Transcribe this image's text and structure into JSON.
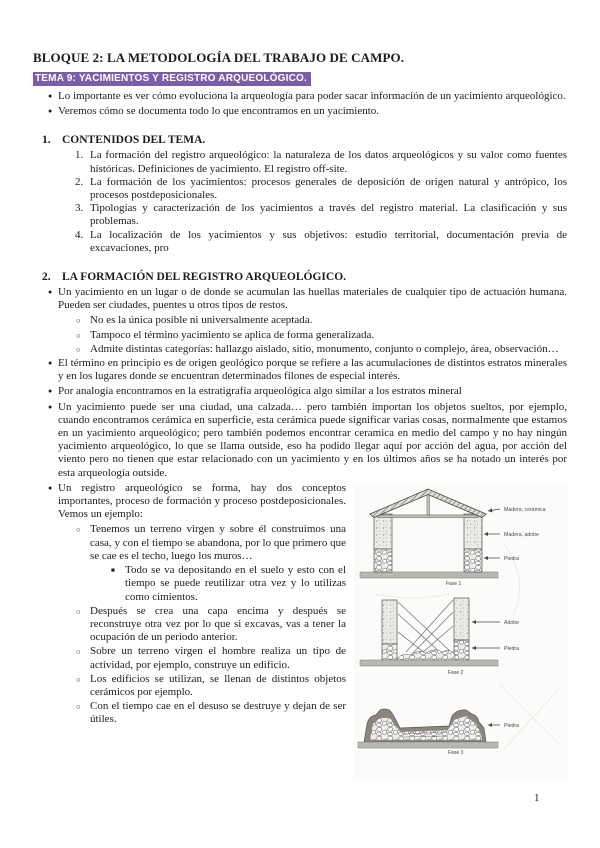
{
  "doc": {
    "title": "BLOQUE 2: LA METODOLOGÍA DEL TRABAJO DE CAMPO.",
    "subtitle": "TEMA 9: YACIMIENTOS Y REGISTRO ARQUEOLÓGICO.",
    "page_number": "1"
  },
  "colors": {
    "highlight_bg": "#7b5ea7",
    "highlight_text": "#ffffff"
  },
  "markers": {
    "level1": "●",
    "level2": "○",
    "level3": "■"
  },
  "intro": {
    "bullets": [
      "Lo importante es ver cómo evoluciona la arqueología para poder sacar información de un yacimiento arqueológico.",
      "Veremos cómo se documenta todo lo que encontramos en un yacimiento."
    ]
  },
  "section1": {
    "number": "1.",
    "heading": "CONTENIDOS DEL TEMA.",
    "items": [
      {
        "num": "1.",
        "text": "La formación del registro arqueológico: la naturaleza de los datos arqueológicos y su valor como fuentes históricas. Definiciones de yacimiento. El registro off-site."
      },
      {
        "num": "2.",
        "text": "La formación de los yacimientos: procesos generales de deposición de origen natural y antrópico, los procesos postdeposicionales."
      },
      {
        "num": "3.",
        "text": "Tipologías y caracterización de los yacimientos a través del registro material. La clasificación y sus problemas."
      },
      {
        "num": "4.",
        "text": "La localización de los yacimientos y sus objetivos: estudio territorial, documentación previa de excavaciones, pro"
      }
    ]
  },
  "section2": {
    "number": "2.",
    "heading": "LA FORMACIÓN DEL REGISTRO ARQUEOLÓGICO.",
    "b1": "Un yacimiento en un lugar o de donde se acumulan las huellas materiales de cualquier tipo de actuación humana. Pueden ser ciudades, puentes u otros tipos de restos.",
    "b1_subs": [
      "No es la única posible ni universalmente aceptada.",
      "Tampoco el término yacimiento se aplica de forma generalizada.",
      "Admite distintas categorías: hallazgo aislado, sitio, monumento, conjunto o complejo, área, observación…"
    ],
    "b2": "El término en principio es de origen geológico porque se refiere a las acumulaciones de distintos estratos minerales y en los lugares donde se encuentran determinados filones de especial interés.",
    "b3": "Por analogía encontramos en la estratigrafía arqueológica algo similar a los estratos mineral",
    "b4": "Un yacimiento puede ser una ciudad, una calzada… pero también importan los objetos sueltos, por ejemplo, cuando encontramos cerámica en superficie, esta cerámica puede significar varias cosas, normalmente que estamos en un yacimiento arqueológico; pero también podemos encontrar ceramica en medio del campo y no hay ningún yacimiento arqueológico, lo que se llama outside, eso ha podido llegar aquí por acción del agua, por acción del viento pero no tienen que estar relacionado con un yacimiento y en los últimos años se ha notado un interés por esta arqueología outside.",
    "b5": "Un registro arqueológico se forma, hay dos conceptos importantes, proceso de formación y proceso postdeposicionales. Vemos un ejemplo:",
    "b5_subs": [
      "Tenemos un terreno virgen y sobre él construimos una casa, y con el tiempo se abandona, por lo que primero que se cae es el techo, luego los muros…",
      "Después se crea una capa encima y después se reconstruye otra vez por lo que si excavas, vas a tener la ocupación de un periodo anterior.",
      "Sobre un terreno virgen el hombre realiza un tipo de actividad, por ejemplo, construye un edificio.",
      "Los edificios se utilizan, se llenan de distintos objetos cerámicos por ejemplo.",
      "Con el tiempo cae en el desuso se destruye y dejan de ser útiles."
    ],
    "b5_sub0_note": "Todo se va depositando en el suelo y esto con el tiempo se puede reutilizar otra vez y lo utilizas como cimientos."
  },
  "figure": {
    "phase1": {
      "caption": "Fase 1",
      "label_roof": "Madera, cerámica",
      "label_wall": "Madera, adobe",
      "label_base": "Piedra"
    },
    "phase2": {
      "caption": "Fase 2",
      "label_wall": "Adobe",
      "label_base": "Piedra"
    },
    "phase3": {
      "caption": "Fase 3",
      "label_rubble": "Piedra"
    }
  }
}
